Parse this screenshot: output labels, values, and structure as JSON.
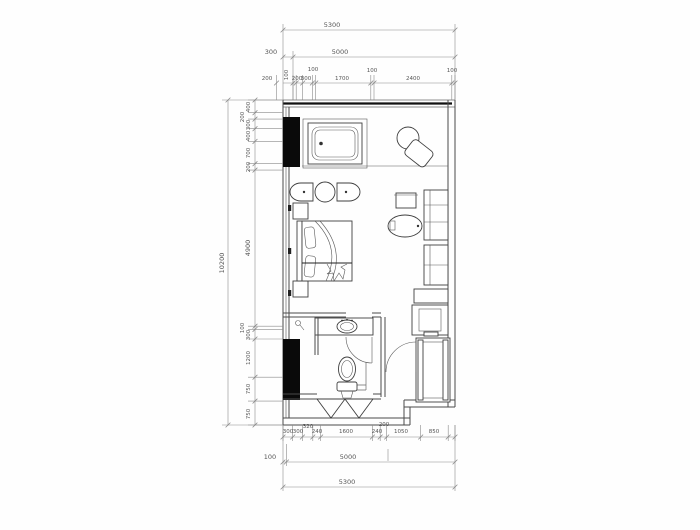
{
  "colors": {
    "wall": "#111111",
    "line": "#4a4a4a",
    "dim_text": "#555555",
    "column_fill": "#0a0a0a",
    "background": "#fefefe"
  },
  "dims": {
    "top": {
      "overall": "5300",
      "offset": "300",
      "inner": "5000",
      "outer": "200",
      "chain": [
        "100",
        "200",
        "300",
        "100",
        "1700",
        "100",
        "2400",
        "100"
      ]
    },
    "left": {
      "overall": "10200",
      "chain": [
        "400",
        "200",
        "300",
        "400",
        "700",
        "200",
        "4900",
        "100",
        "300",
        "1200",
        "750",
        "750"
      ]
    },
    "bottom": {
      "chain": [
        "300",
        "300",
        "320",
        "240",
        "1600",
        "240",
        "200",
        "1050",
        "850"
      ],
      "offset": "100",
      "inner": "5000",
      "overall": "5300"
    }
  }
}
